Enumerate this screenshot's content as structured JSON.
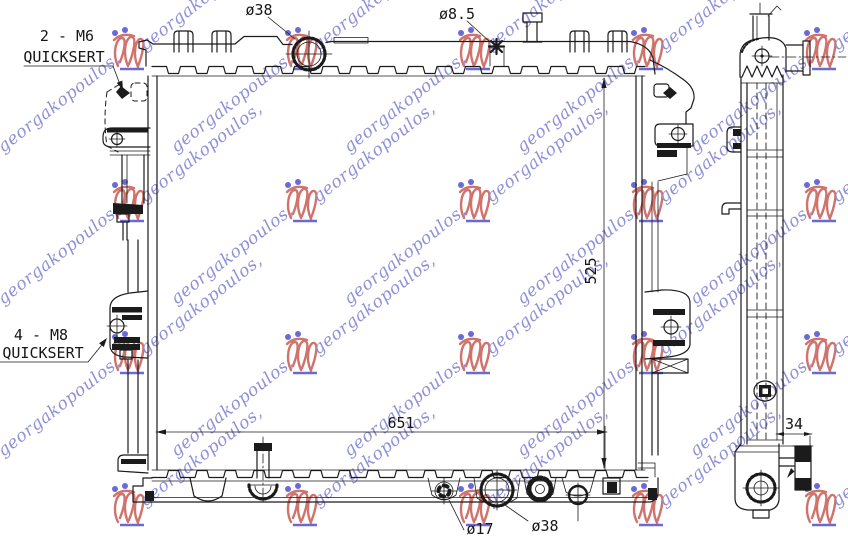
{
  "drawing": {
    "labels": {
      "insert_top_qty": "2 - M6",
      "insert_top_type": "QUICKSERT",
      "insert_bottom_qty": "4 - M8",
      "insert_bottom_type": "QUICKSERT",
      "filler_neck_dia": "ø38",
      "mount_hole_dia": "ø8.5",
      "drain_dia": "ø17",
      "outlet_dia": "ø38",
      "core_width_mm": "651",
      "core_height_mm": "525",
      "core_depth_mm": "34"
    }
  },
  "watermark": {
    "script_text": "georgakopoulos,",
    "script_color": "#9090d8",
    "logo_stroke": "#d0736c",
    "logo_accent": "#6a6ad6"
  }
}
